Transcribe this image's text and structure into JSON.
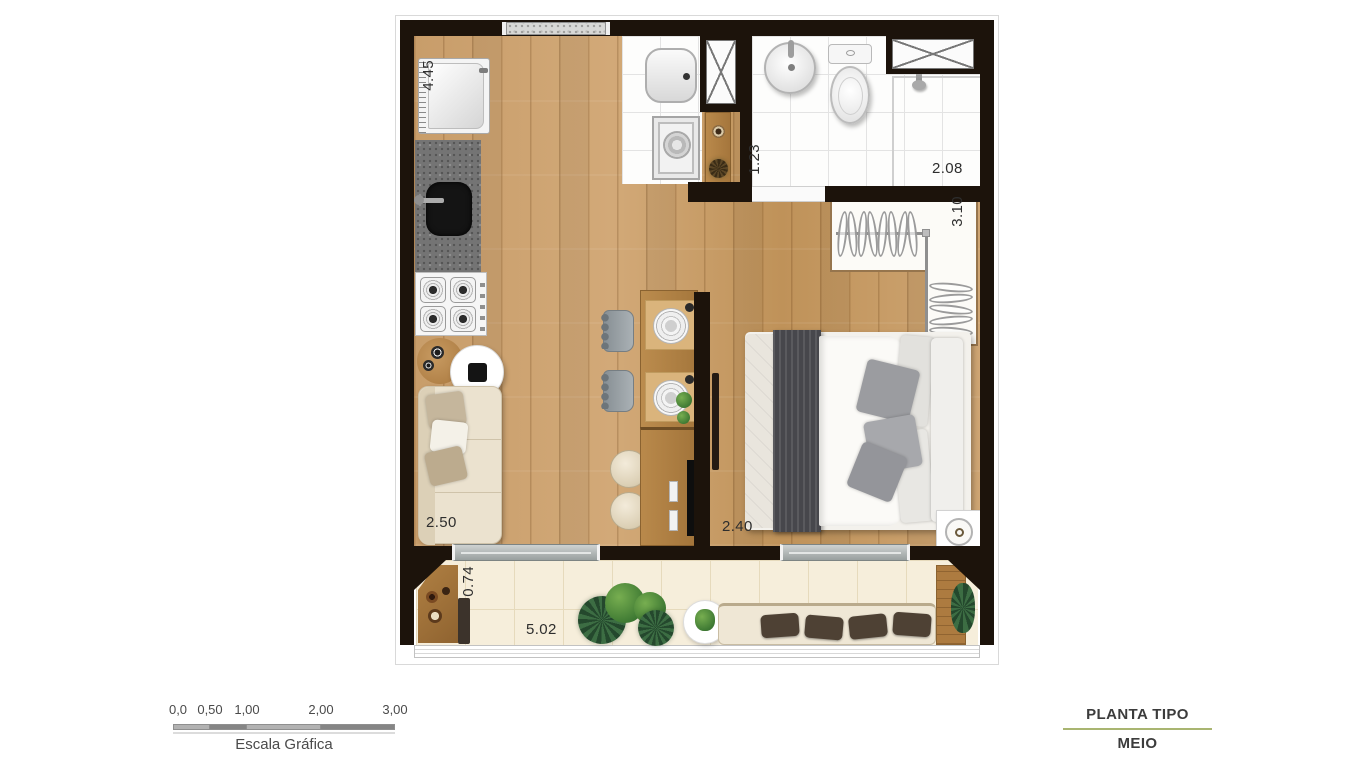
{
  "plan": {
    "measurements": {
      "kitchen_side": "4.45",
      "bathroom_side": "1.23",
      "bathroom_back": "2.08",
      "closet_side": "3.10",
      "living_front": "2.50",
      "bedroom_front": "2.40",
      "balcony_depth": "0.74",
      "balcony_front": "5.02"
    }
  },
  "scalebar": {
    "ticks": [
      "0,0",
      "0,50",
      "1,00",
      "2,00",
      "3,00"
    ],
    "caption": "Escala Gráfica"
  },
  "legend": {
    "title": "PLANTA TIPO",
    "subtitle": "MEIO",
    "divider_color": "#a9b571"
  }
}
